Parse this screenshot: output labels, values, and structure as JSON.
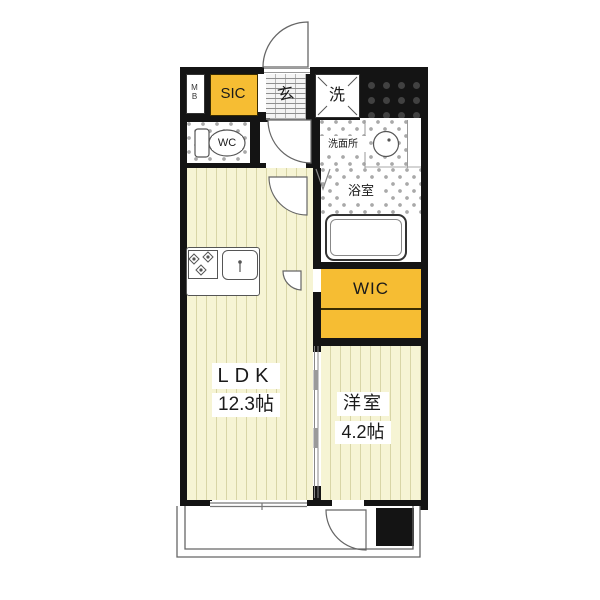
{
  "rooms": {
    "mb": {
      "line1": "M",
      "line2": "B"
    },
    "sic": {
      "label": "SIC"
    },
    "genkan": {
      "label": "玄"
    },
    "laundry": {
      "label": "洗"
    },
    "wc": {
      "label": "WC"
    },
    "washroom": {
      "label": "洗面所"
    },
    "bathroom": {
      "label": "浴室"
    },
    "wic": {
      "label": "WIC"
    },
    "ldk": {
      "name": "LDK",
      "size": "12.3帖"
    },
    "western": {
      "name": "洋室",
      "size": "4.2帖"
    }
  },
  "colors": {
    "wall": "#141414",
    "accent_yellow": "#F6BD33",
    "floor": "#F6F4D4"
  }
}
